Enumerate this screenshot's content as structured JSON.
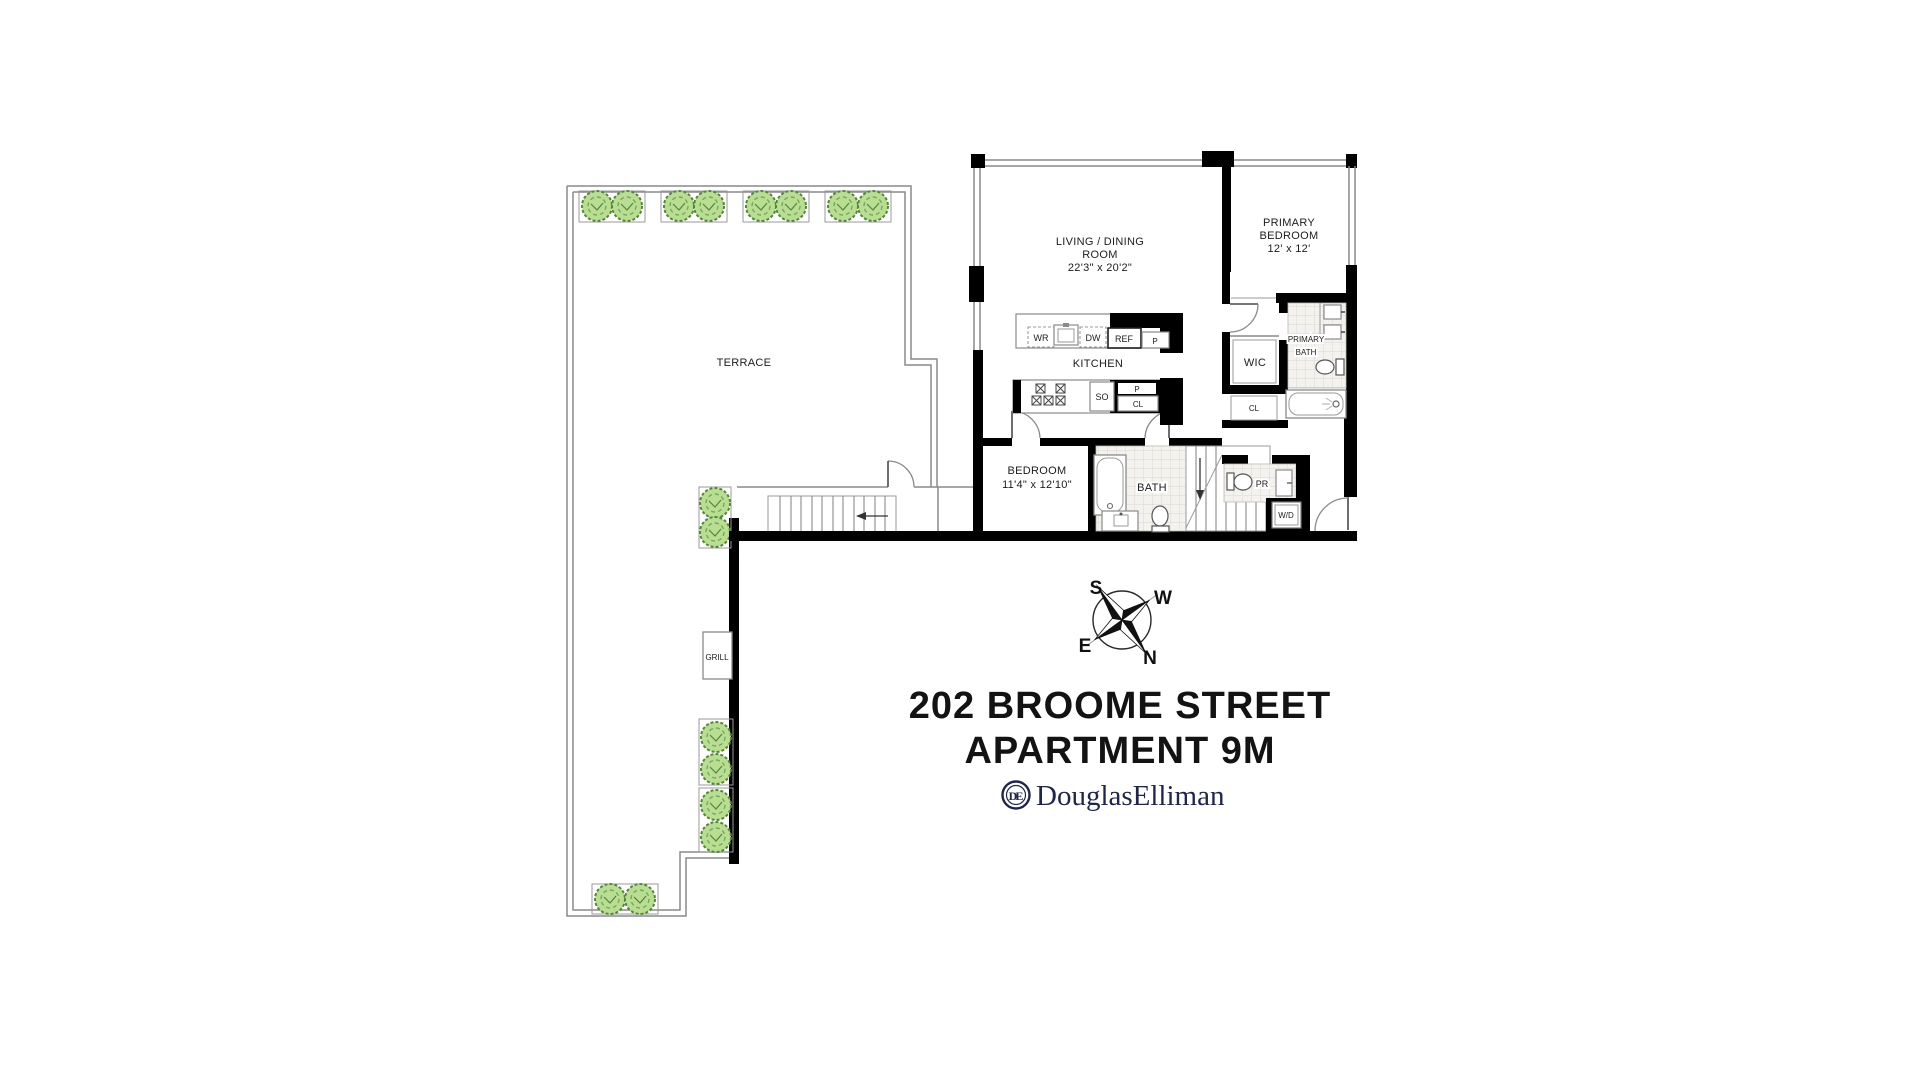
{
  "document": {
    "kind": "residential-floor-plan"
  },
  "title": {
    "line1": "202 BROOME STREET",
    "line2": "APARTMENT 9M"
  },
  "brand": {
    "monogram": "DE",
    "name": "DouglasElliman"
  },
  "compass": {
    "s": "S",
    "w": "W",
    "e": "E",
    "n": "N"
  },
  "terrace": {
    "label": "TERRACE",
    "grill": "GRILL"
  },
  "rooms": {
    "living": {
      "line1": "LIVING / DINING",
      "line2": "ROOM",
      "dims": "22'3\" x 20'2\""
    },
    "primary_bedroom": {
      "line1": "PRIMARY",
      "line2": "BEDROOM",
      "dims": "12' x 12'"
    },
    "bedroom": {
      "line1": "BEDROOM",
      "dims": "11'4\" x 12'10\""
    },
    "kitchen": {
      "label": "KITCHEN"
    },
    "bath": {
      "label": "BATH"
    },
    "primary_bath": {
      "line1": "PRIMARY",
      "line2": "BATH"
    },
    "wic": {
      "label": "WIC"
    },
    "powder_room": {
      "label": "PR"
    }
  },
  "fixtures": {
    "wine_ref": "WR",
    "dishwasher": "DW",
    "refrigerator": "REF",
    "pantry_upper": "P",
    "stacked_oven": "SO",
    "pantry_lower": "P",
    "closet_kitchen": "CL",
    "closet_hall": "CL",
    "washer_dryer": "W/D"
  },
  "colors": {
    "walls": "#000000",
    "thin_line": "#8a8a8a",
    "plant_fill": "#b9de93",
    "plant_stroke": "#55843a",
    "tile_fill": "#f3f2ee",
    "logo_navy": "#20264a",
    "title_text": "#131313"
  }
}
